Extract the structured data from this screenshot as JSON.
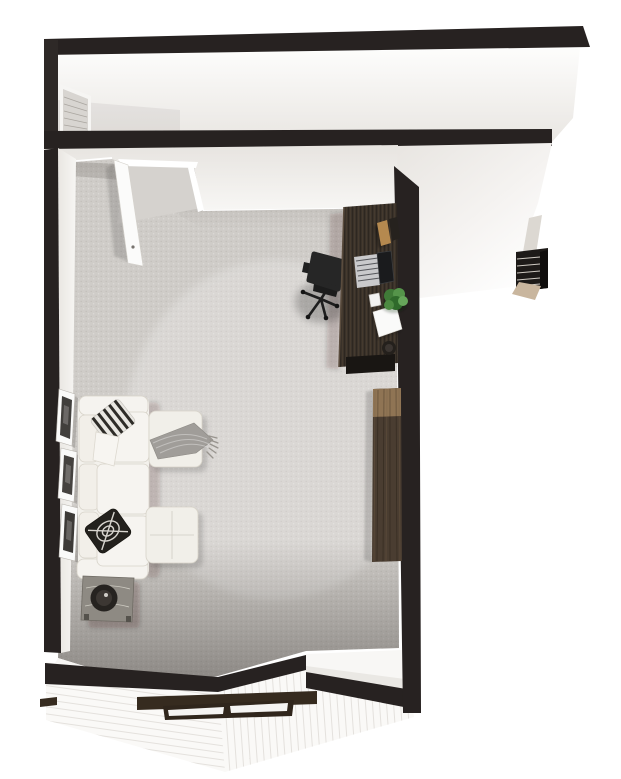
{
  "scene": {
    "title": "3D floor plan render",
    "view": "top-down dollhouse view",
    "areas": {
      "hallway": "corridor along the top with dark wall caps and a door at its west end",
      "main_room": "carpeted home office / living room",
      "staircase": "small stair run descending at the far right wing",
      "roof": "white-sided roof with a framed window at the bottom edge"
    },
    "objects": [
      "hallway-end-door",
      "room-door-open",
      "desk",
      "laptop",
      "books",
      "smartphone",
      "desk-plant",
      "paper-sheet",
      "cup",
      "office-chair",
      "wood-console",
      "sectional-sofa",
      "striped-pillow",
      "white-pillow",
      "patterned-pillow",
      "ottoman-with-throw",
      "ottoman",
      "gray-throw-blanket",
      "side-table",
      "decorative-bowl",
      "picture-frames",
      "stairs",
      "roof-window"
    ]
  },
  "colors": {
    "background": "#ffffff",
    "wall_cap": "#272221",
    "wall_cap_soft": "#2e2927",
    "wall_face": "#f1efec",
    "left_wall_face": "#f3f1ee",
    "hall_end_door": "#d8d5d1",
    "door_leaf": "#fbfbfa",
    "carpet": "#cfccc8",
    "carpet_nook": "#d5d2ce",
    "white_wedge": "#f7f6f4",
    "ridge_white": "#f8f7f5",
    "ridge_shade": "#eae8e4",
    "roof_siding": "#faf9f7",
    "window_frame": "#362b1f",
    "window_pane": "#f5f4f2",
    "desk_wood": "#3a322a",
    "desk_underbar": "#191613",
    "book_tan": "#b5894f",
    "book_dark": "#26221e",
    "laptop_deck": "#c9c9cb",
    "laptop_screen": "#1a1b1d",
    "phone_white": "#f2f2f1",
    "paper_white": "#fafaf9",
    "cup_dark": "#24201c",
    "cup_inner": "#3b3531",
    "plant_green_1": "#3f7a37",
    "plant_green_2": "#55944a",
    "plant_green_3": "#2f6a2b",
    "plant_green_4": "#4c8a41",
    "plant_green_5": "#66a65a",
    "chair_black": "#262626",
    "chair_seat": "#1c1c1c",
    "console_wood": "#4a3d31",
    "console_wood_light": "#8f7454",
    "sofa_fabric": "#f3f1ec",
    "sofa_cushion": "#f6f4f0",
    "sofa_back_cushion": "#f2efe9",
    "pillow_stripe_base": "#e9e7e2",
    "pillow_stripe_dark": "#2e2c28",
    "pillow_dark": "#23211d",
    "pillow_white": "#f7f5f1",
    "ottoman_fabric": "#f1efe9",
    "throw_gray": "#a09d99",
    "table_wood": "#8e8a83",
    "bowl_dark": "#262320",
    "bowl_inner": "#3c3733",
    "stair_black": "#1d1a18",
    "stair_side": "#0f0d0c",
    "stair_base_tan": "#c9b69e",
    "stair_wall": "#dcd8d2"
  }
}
